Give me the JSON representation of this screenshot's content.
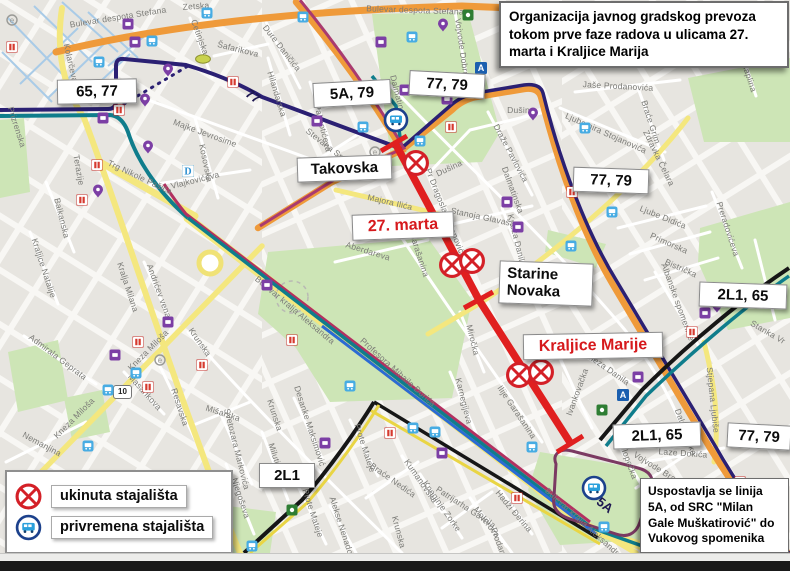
{
  "header": {
    "title": "Organizacija javnog gradskog prevoza tokom prve faze radova u ulicama 27. marta i Kraljice Marija"
  },
  "note": {
    "text": "Uspostavlja se linija 5A, od SRC \"Milan Gale Muškatirović\" do Vukovog spomenika"
  },
  "legend": {
    "items": [
      {
        "id": "cancelled",
        "label": "ukinuta stajališta"
      },
      {
        "id": "temporary",
        "label": "privremena stajališta"
      }
    ]
  },
  "route_labels": [
    {
      "text": "65, 77",
      "x": 57,
      "y": 79,
      "w": 80,
      "rot": -1,
      "red": false
    },
    {
      "text": "5A, 79",
      "x": 313,
      "y": 81,
      "w": 78,
      "rot": -3,
      "red": false
    },
    {
      "text": "77, 79",
      "x": 409,
      "y": 72,
      "w": 76,
      "rot": 3,
      "red": false
    },
    {
      "text": "Takovska",
      "x": 297,
      "y": 156,
      "w": 95,
      "rot": -2,
      "red": false
    },
    {
      "text": "27. marta",
      "x": 352,
      "y": 213,
      "w": 102,
      "rot": -2,
      "red": true
    },
    {
      "text": "Starine Novaka",
      "x": 499,
      "y": 262,
      "w": 94,
      "rot": 2,
      "red": false,
      "align": "left"
    },
    {
      "text": "77, 79",
      "x": 573,
      "y": 168,
      "w": 76,
      "rot": 2,
      "red": false
    },
    {
      "text": "2L1, 65",
      "x": 699,
      "y": 283,
      "w": 88,
      "rot": 2,
      "red": false
    },
    {
      "text": "Kraljice Marije",
      "x": 523,
      "y": 333,
      "w": 140,
      "rot": -1,
      "red": true
    },
    {
      "text": "2L1, 65",
      "x": 613,
      "y": 423,
      "w": 88,
      "rot": -2,
      "red": false
    },
    {
      "text": "77, 79",
      "x": 727,
      "y": 424,
      "w": 64,
      "rot": 3,
      "red": false
    },
    {
      "text": "2L1",
      "x": 259,
      "y": 463,
      "w": 56,
      "rot": 0,
      "red": false
    }
  ],
  "inline_labels": [
    {
      "text": "77",
      "x": 253,
      "y": 96,
      "rot": 36
    },
    {
      "text": "5A",
      "x": 605,
      "y": 505,
      "rot": 38
    }
  ],
  "road_badge": {
    "text": "10",
    "x": 113,
    "y": 385
  },
  "street_labels": [
    [
      "Zetska",
      196,
      6,
      -4
    ],
    [
      "Bulevar despota Stefana",
      118,
      17,
      -9
    ],
    [
      "Bulevar despota Stefana",
      415,
      10,
      2
    ],
    [
      "Kolarčeva",
      71,
      63,
      77
    ],
    [
      "Terazije",
      79,
      170,
      80
    ],
    [
      "Prizrenska",
      17,
      127,
      72
    ],
    [
      "Majke Jevrosime",
      205,
      133,
      20
    ],
    [
      "Šafarikova",
      238,
      49,
      14
    ],
    [
      "Cetinjska",
      200,
      37,
      70
    ],
    [
      "Hilandarska",
      277,
      94,
      73
    ],
    [
      "Dure Daničića",
      282,
      48,
      52
    ],
    [
      "Kosovska",
      206,
      163,
      78
    ],
    [
      "Vlajkovićeva",
      195,
      180,
      -14
    ],
    [
      "Palmotićeva",
      323,
      128,
      76
    ],
    [
      "Stevana Sremca",
      333,
      150,
      38
    ],
    [
      "Trg Nikole Pašića",
      140,
      177,
      25
    ],
    [
      "Kralja Milana",
      128,
      287,
      72
    ],
    [
      "Majora Ilića",
      390,
      202,
      13
    ],
    [
      "Dalmatinska",
      399,
      99,
      76
    ],
    [
      "Dalmatinska",
      513,
      190,
      70
    ],
    [
      "Dalmatinska",
      686,
      432,
      70
    ],
    [
      "Dušina",
      521,
      110,
      0
    ],
    [
      "Dušina",
      449,
      168,
      -25
    ],
    [
      "Draže Pavlovića",
      511,
      153,
      62
    ],
    [
      "Vojvode Dobrnjca",
      463,
      53,
      82
    ],
    [
      "Jaše Prodanovića",
      618,
      86,
      3
    ],
    [
      "Ljubomira Stojanovića",
      606,
      133,
      24
    ],
    [
      "Braće Grim",
      651,
      122,
      72
    ],
    [
      "Čarlija Čaplina",
      745,
      64,
      72
    ],
    [
      "Zdravka Čelara",
      659,
      158,
      64
    ],
    [
      "Ljube Didića",
      663,
      217,
      22
    ],
    [
      "Primorska",
      669,
      243,
      24
    ],
    [
      "Bistrička",
      681,
      268,
      24
    ],
    [
      "Preradovićeva",
      728,
      229,
      72
    ],
    [
      "Albanske spomenice",
      678,
      302,
      70
    ],
    [
      "Stjepana Ljubiše",
      713,
      400,
      84
    ],
    [
      "Stanka Vr",
      768,
      332,
      30
    ],
    [
      "Pr Dragoslava Popovića",
      446,
      213,
      68
    ],
    [
      "Stanoja Glavaša",
      483,
      217,
      12
    ],
    [
      "Kneza Danila",
      517,
      240,
      76
    ],
    [
      "Kneza Danila",
      607,
      368,
      35
    ],
    [
      "Ivankovačka",
      577,
      392,
      -70
    ],
    [
      "Miročka",
      473,
      340,
      76
    ],
    [
      "Ilije Garašanina",
      517,
      412,
      56
    ],
    [
      "Ilije Garašanina",
      417,
      247,
      72
    ],
    [
      "Aberdareva",
      368,
      251,
      17
    ],
    [
      "Karnegijeva",
      464,
      401,
      76
    ],
    [
      "Profesora Mihaila Đurića",
      398,
      372,
      42
    ],
    [
      "Bulevar kralja Aleksandra",
      295,
      310,
      40
    ],
    [
      "Bulevar kralja Aleksandra",
      584,
      523,
      42
    ],
    [
      "Krunska",
      200,
      342,
      55
    ],
    [
      "Krunska",
      275,
      415,
      72
    ],
    [
      "Krunska",
      399,
      532,
      75
    ],
    [
      "Resavska",
      180,
      407,
      72
    ],
    [
      "Mišarska",
      223,
      413,
      18
    ],
    [
      "Svetozara Markovića",
      237,
      449,
      76
    ],
    [
      "Masarikova",
      145,
      392,
      48
    ],
    [
      "Admirala Geprata",
      58,
      357,
      37
    ],
    [
      "Nemanjina",
      42,
      444,
      28
    ],
    [
      "Kneza Miloša",
      74,
      418,
      -45
    ],
    [
      "Kneza Miloša",
      148,
      350,
      -45
    ],
    [
      "Kraljice Natalije",
      44,
      268,
      72
    ],
    [
      "Balkanska",
      62,
      218,
      76
    ],
    [
      "Andrićev venac",
      160,
      293,
      70
    ],
    [
      "Njegoševa",
      241,
      498,
      72
    ],
    [
      "Milutina",
      276,
      458,
      72
    ],
    [
      "Desanke Maksimović",
      310,
      426,
      72
    ],
    [
      "Prote Mateje",
      365,
      448,
      72
    ],
    [
      "Prote Mateje",
      313,
      513,
      72
    ],
    [
      "Braće Nedića",
      393,
      480,
      35
    ],
    [
      "Kumanovska",
      421,
      481,
      55
    ],
    [
      "Kneginje Zorke",
      442,
      506,
      55
    ],
    [
      "Patrijarha Gavrila",
      466,
      507,
      33
    ],
    [
      "Molerova",
      487,
      522,
      52
    ],
    [
      "Hadži Đerina",
      514,
      511,
      50
    ],
    [
      "Prodanova",
      501,
      548,
      70
    ],
    [
      "Alekse Nenadovića",
      344,
      533,
      72
    ],
    [
      "Čelopečka",
      628,
      459,
      70
    ],
    [
      "Laze Dokića",
      683,
      453,
      4
    ],
    [
      "Vojvode Brane",
      659,
      469,
      32
    ]
  ],
  "markers": {
    "cancelled": [
      [
        416,
        163
      ],
      [
        452,
        265
      ],
      [
        472,
        261
      ],
      [
        519,
        375
      ],
      [
        541,
        372
      ]
    ],
    "temporary": [
      [
        396,
        120
      ],
      [
        594,
        488
      ]
    ],
    "bus_stops": [
      [
        303,
        17
      ],
      [
        207,
        13
      ],
      [
        99,
        62
      ],
      [
        152,
        41
      ],
      [
        412,
        37
      ],
      [
        363,
        127
      ],
      [
        420,
        141
      ],
      [
        585,
        128
      ],
      [
        571,
        246
      ],
      [
        612,
        212
      ],
      [
        108,
        390
      ],
      [
        136,
        373
      ],
      [
        88,
        446
      ],
      [
        252,
        546
      ],
      [
        350,
        386
      ],
      [
        413,
        428
      ],
      [
        435,
        432
      ],
      [
        532,
        447
      ],
      [
        648,
        440
      ],
      [
        604,
        527
      ]
    ],
    "poi_purple": [
      [
        135,
        42
      ],
      [
        128,
        24
      ],
      [
        103,
        118
      ],
      [
        381,
        42
      ],
      [
        405,
        90
      ],
      [
        447,
        99
      ],
      [
        317,
        121
      ],
      [
        267,
        285
      ],
      [
        115,
        355
      ],
      [
        325,
        443
      ],
      [
        507,
        202
      ],
      [
        518,
        227
      ],
      [
        638,
        377
      ],
      [
        705,
        313
      ],
      [
        442,
        453
      ],
      [
        168,
        322
      ]
    ],
    "poi_pin": [
      [
        168,
        70
      ],
      [
        145,
        100
      ],
      [
        148,
        147
      ],
      [
        98,
        191
      ],
      [
        717,
        306
      ],
      [
        443,
        25
      ],
      [
        533,
        114
      ]
    ],
    "poi_red": [
      [
        12,
        47
      ],
      [
        233,
        82
      ],
      [
        97,
        165
      ],
      [
        82,
        200
      ],
      [
        292,
        340
      ],
      [
        138,
        342
      ],
      [
        148,
        387
      ],
      [
        202,
        365
      ],
      [
        451,
        127
      ],
      [
        445,
        220
      ],
      [
        390,
        433
      ],
      [
        517,
        498
      ],
      [
        572,
        192
      ],
      [
        692,
        332
      ],
      [
        740,
        482
      ],
      [
        119,
        110
      ]
    ],
    "poi_green": [
      [
        468,
        15
      ],
      [
        292,
        510
      ],
      [
        602,
        410
      ]
    ],
    "poi_blue_a": [
      [
        481,
        68
      ],
      [
        623,
        395
      ]
    ],
    "poi_letter_d": [
      [
        188,
        171
      ]
    ],
    "poi_e": [
      [
        12,
        20
      ],
      [
        375,
        152
      ],
      [
        160,
        360
      ]
    ],
    "poi_oval": [
      [
        203,
        59
      ]
    ]
  },
  "colors": {
    "closed_route": "#e01f1f",
    "label_red": "#d6191c",
    "navy": "#2b2073",
    "teal": "#0f7d8c",
    "orange": "#ef9a3a",
    "magenta": "#a93a6f",
    "maroon": "#b23060",
    "line_black": "#161616",
    "line_yellow": "#e9d544",
    "line_blue": "#2b6bd4",
    "loop_purple": "#7b3962",
    "park": "#cde5b6",
    "road_yellow": "#f4e77e",
    "water_blue": "#a9cbe7"
  }
}
